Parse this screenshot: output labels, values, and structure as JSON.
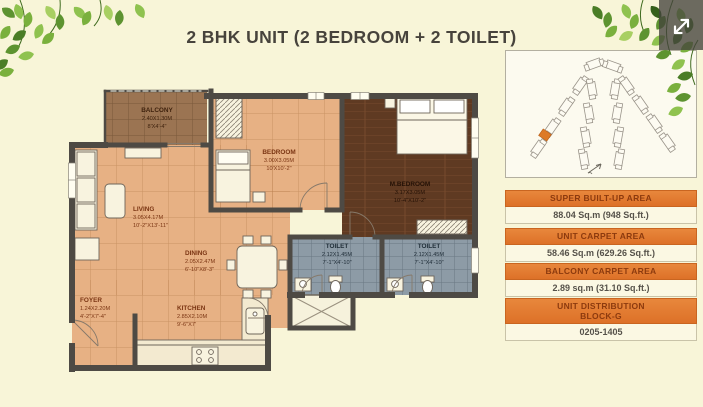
{
  "title": "2 BHK UNIT (2 BEDROOM + 2 TOILET)",
  "floor_plan": {
    "rooms": {
      "balcony": {
        "name": "BALCONY",
        "metric": "2.40X1.30M",
        "imperial": "8'X4'-4\""
      },
      "bedroom": {
        "name": "BEDROOM",
        "metric": "3.00X3.05M",
        "imperial": "10'X10'-2\""
      },
      "master_bedroom": {
        "name": "M.BEDROOM",
        "metric": "3.17X3.05M",
        "imperial": "10'-4\"X10'-2\""
      },
      "living": {
        "name": "LIVING",
        "metric": "3.05X4.17M",
        "imperial": "10'-2\"X13'-11\""
      },
      "dining": {
        "name": "DINING",
        "metric": "2.05X2.47M",
        "imperial": "6'-10\"X8'-3\""
      },
      "foyer": {
        "name": "FOYER",
        "metric": "1.24X2.20M",
        "imperial": "4'-2\"X7'-4\""
      },
      "kitchen": {
        "name": "KITCHEN",
        "metric": "2.85X2.10M",
        "imperial": "9'-6\"X7'"
      },
      "toilet_1": {
        "name": "TOILET",
        "metric": "2.12X1.45M",
        "imperial": "7'-1\"X4'-10\""
      },
      "toilet_2": {
        "name": "TOILET",
        "metric": "2.12X1.45M",
        "imperial": "7'-1\"X4'-10\""
      }
    }
  },
  "info_cards": [
    {
      "header": "SUPER BUILT-UP AREA",
      "value": "88.04 Sq.m (948 Sq.ft.)"
    },
    {
      "header": "UNIT CARPET AREA",
      "value": "58.46 Sq.m (629.26 Sq.ft.)"
    },
    {
      "header": "BALCONY CARPET AREA",
      "value": "2.89 sq.m (31.10 Sq.ft.)"
    },
    {
      "header": "UNIT DISTRIBUTION",
      "header_line2": "BLOCK-G",
      "value": "0205-1405"
    }
  ],
  "colors": {
    "accent_orange": "#e0772c",
    "header_text": "#8c3a0e",
    "background": "#f8f5d8",
    "floor_peach": "#e7b184",
    "floor_balcony": "#9b7452",
    "floor_wood": "#5f3a22",
    "floor_toilet": "#8d9ba6",
    "wall": "#4e4a44",
    "leaf_green": "#7ab03d",
    "siteplan_highlight": "#dd7a28"
  }
}
